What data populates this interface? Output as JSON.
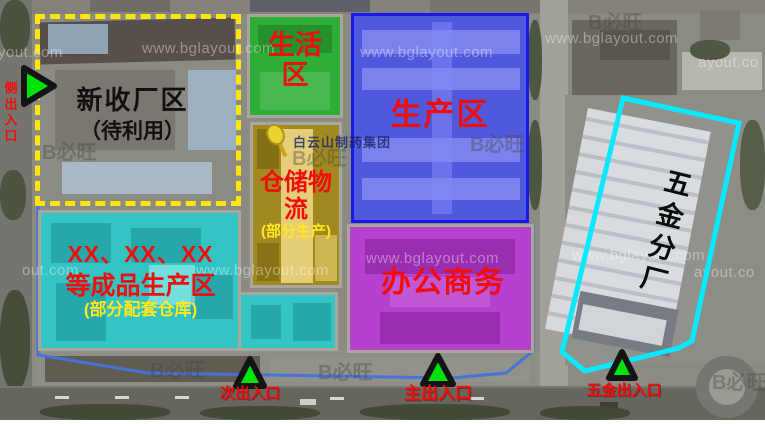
{
  "zones": {
    "new_factory": {
      "name": "新收厂区",
      "status": "（待利用）",
      "outline_color": "#ffe60a",
      "text_color": "#111111"
    },
    "living": {
      "name": "生活区",
      "fill": "#2fae37",
      "text_color": "#f20d0d"
    },
    "production": {
      "name": "生产区",
      "fill": "#5058dc",
      "border": "#1717ee",
      "text_color": "#f20d0d"
    },
    "warehouse": {
      "name": "仓储物流",
      "note": "(部分生产)",
      "fill": "#a2891f",
      "text_color": "#f20d0d",
      "note_color": "#ffe81e"
    },
    "finished": {
      "name_line1": "XX、XX、XX",
      "name_line2": "等成品生产区",
      "note": "(部分配套仓库)",
      "fill": "#35c4c4",
      "text_color": "#f20d0d",
      "note_color": "#ffe81e"
    },
    "office": {
      "name": "办公商务",
      "fill": "#b840cf",
      "text_color": "#f20d0d"
    },
    "hardware": {
      "name": "五金分厂",
      "outline_color": "#07e9fe",
      "text_color": "#0b0b0b"
    }
  },
  "entrances": {
    "side": {
      "label": "侧出入口"
    },
    "secondary": {
      "label": "次出入口"
    },
    "main": {
      "label": "主出入口"
    },
    "hardware": {
      "label": "五金出入口"
    },
    "marker_color": "#00e30a",
    "label_color": "#f20d0d"
  },
  "map": {
    "poi_label": "白云山制药集团",
    "site_boundary_color": "#4273dd"
  },
  "watermarks": {
    "url": "www.bglayout.com",
    "url_partial_left": "yout.com",
    "url_partial_mid": "out.com",
    "url_partial_right": "ayout.co",
    "logo": "B必旺"
  }
}
